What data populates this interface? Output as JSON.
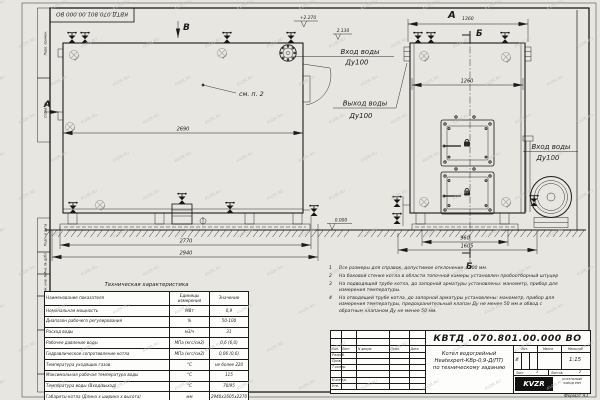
{
  "watermark": "KVZR.RU",
  "frame": {
    "stamp": "КВТД.070.801.00.000 ВО",
    "labels": [
      "Перв. примен.",
      "Справ. №",
      "Подп. и дата",
      "Инв. № дубл.",
      "Взам. инв. №",
      "Подп. и дата",
      "Инв. № подл."
    ]
  },
  "views": {
    "side": {
      "label_v": "В",
      "label_a": "А",
      "callout": "см. п. 2",
      "dim_top": "2690",
      "dim_mid": "2770",
      "dim_bottom": "2940",
      "elev_top": "+2.270",
      "elev_mid": "2.130",
      "elev_ground": "0.000",
      "inlet_label": "Вход воды",
      "inlet_size": "Ду100",
      "outlet_label": "Выход воды",
      "outlet_size": "Ду100"
    },
    "front": {
      "label_a": "А",
      "dim_width": "1360",
      "label_b_top": "Б",
      "label_b_bottom": "Б",
      "dim_inner": "1260",
      "dim_base": "960",
      "dim_full": "1605",
      "inlet_label": "Вход воды",
      "inlet_size": "Ду100"
    }
  },
  "notes": {
    "items": [
      {
        "num": "1",
        "text": "Все размеры для справок, допустимое отклонение ±100 мм."
      },
      {
        "num": "2",
        "text": "На боковой стенке котла в области топочной камеры установлен пробоотборный штуцер"
      },
      {
        "num": "3",
        "text": "На  подводящей трубе котла, до запорной арматуры установлены: манометр, прибор для измерения температуры."
      },
      {
        "num": "4",
        "text": "На отводящей трубе котла, до запорной арматуры установлены: манометр, прибор для измерения температуры, предохранительный клапан Ду не менее 50 мм и обвод с обратным клапаном Ду не менее 50 мм."
      }
    ]
  },
  "tech_table": {
    "title": "Техническая характеристика",
    "headers": [
      "Наименование показателя",
      "Единицы измерения",
      "Значение"
    ],
    "rows": [
      [
        "Номинальная мощность",
        "МВт",
        "0,9"
      ],
      [
        "Диапазон рабочего регулирования",
        "%",
        "50-100"
      ],
      [
        "Расход воды",
        "м3/ч",
        "31"
      ],
      [
        "Рабочее давление воды",
        "МПа (кгс/см2)",
        "0,6 (6,0)"
      ],
      [
        "Гидравлическое сопротивление котла",
        "МПа (кгс/см2)",
        "0,06 (0,6)"
      ],
      [
        "Температура уходящих газов",
        "°С",
        "не более 220"
      ],
      [
        "Максимальная рабочая температура воды",
        "°С",
        "115"
      ],
      [
        "Температура воды (Вход/выход)",
        "°С",
        "70/95"
      ],
      [
        "Габариты котла (Длина х ширина х высота)",
        "мм",
        "2940х1605х2270"
      ]
    ]
  },
  "title_block": {
    "doc_number": "КВТД .070.801.00.000  ВО",
    "product": [
      "Котел водогрейный",
      "Heatexpert-КВр-0,9-Д(ПТ)",
      "по техническому заданию"
    ],
    "header": [
      "Изм.",
      "Лист",
      "N докум.",
      "Подп.",
      "Дата"
    ],
    "rows": [
      "Разраб.",
      "Пров.",
      "Т.контр.",
      "Н.контр.",
      "Утв."
    ],
    "lit_label": "Лит.",
    "lit_value": "И",
    "mass_label": "Масса",
    "scale_label": "Масштаб",
    "scale_value": "1:15",
    "sheet_label": "Лист",
    "sheet_value": "1",
    "sheets_label": "Листов",
    "sheets_value": "2",
    "logo": "KVZR",
    "company": [
      "КОТЕЛЬНЫЙ",
      "ЗАВОД РЭП"
    ],
    "format": "Формат  А3"
  }
}
